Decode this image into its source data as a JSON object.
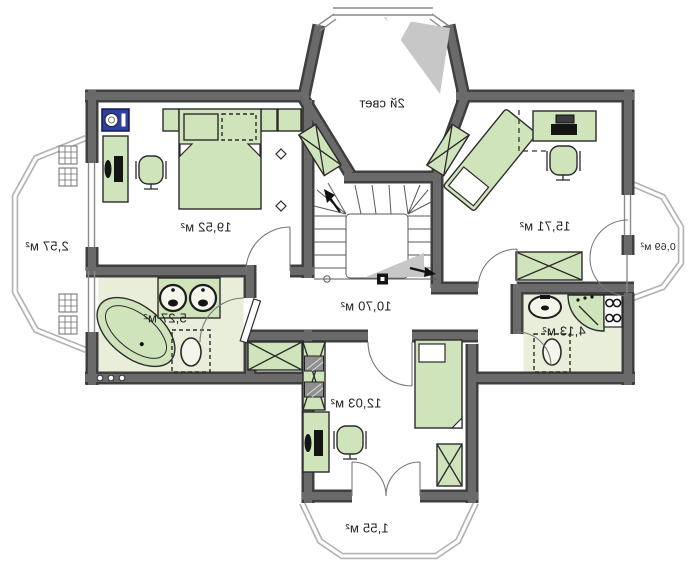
{
  "colors": {
    "wall-dark": "#3f3f3f",
    "wall-light": "#6a6a6a",
    "furniture": "#cfe4ba",
    "bath-floor": "#e9eedb",
    "roof-shade": "#c7c7c7",
    "accent-blue": "#2e3f9f"
  },
  "labels": {
    "second_light": "2й свет",
    "bedroom_left": "19,52 м²",
    "bedroom_right": "15,71 м²",
    "hall": "10,70 м²",
    "bathroom_left": "5,27 м²",
    "bathroom_right": "4,13 м²",
    "bottom_room": "12,03 м²",
    "balcony_left": "2,57 м²",
    "balcony_right": "0,69 м²",
    "balcony_bottom": "1,55 м²"
  }
}
